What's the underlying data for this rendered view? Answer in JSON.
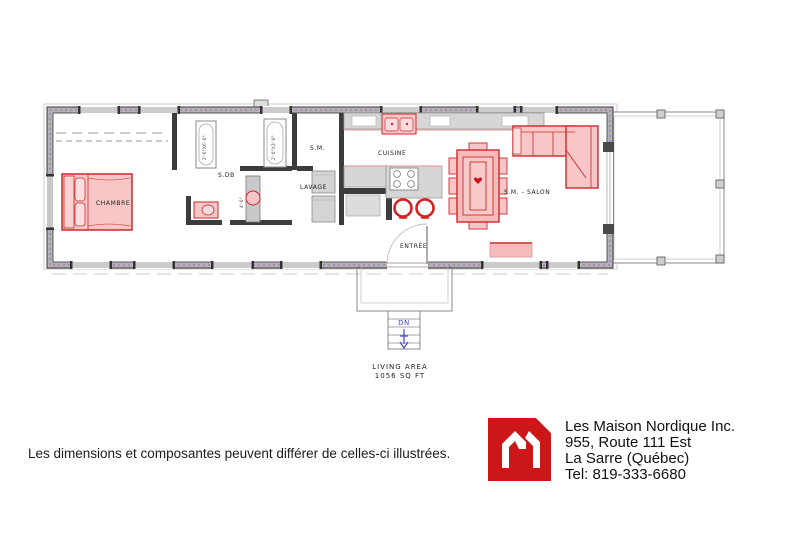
{
  "plan": {
    "rooms": {
      "chambre": "CHAMBRE",
      "sdb": "S.DB",
      "sm": "S.M.",
      "lavage": "LAVAGE",
      "cuisine": "CUISINE",
      "entree": "ENTRÉE",
      "salon": "S.M. - SALON"
    },
    "fixtures": {
      "tub_dim": "2'-6\"X6'-0\"",
      "shower_dim": "2'-6\"X3'-0\"",
      "vanity_dim": "4'-0\""
    },
    "stairs": {
      "down_label": "DN"
    },
    "area": {
      "line1": "LIVING AREA",
      "line2": "1056 SQ FT"
    }
  },
  "disclaimer": "Les dimensions et composantes peuvent différer de celles-ci illustrées.",
  "company": {
    "name": "Les Maison Nordique Inc.",
    "address_line1": "955, Route 111 Est",
    "address_line2": "La Sarre (Québec)",
    "phone": "Tel: 819-333-6680"
  },
  "colors": {
    "furniture_fill": "#f8c6c6",
    "furniture_stroke": "#cc2a2a",
    "wall_fill": "#b3b3b3",
    "insulation_purple": "#a060c8",
    "stair_blue": "#4747c8",
    "logo_red": "#cc1719"
  }
}
